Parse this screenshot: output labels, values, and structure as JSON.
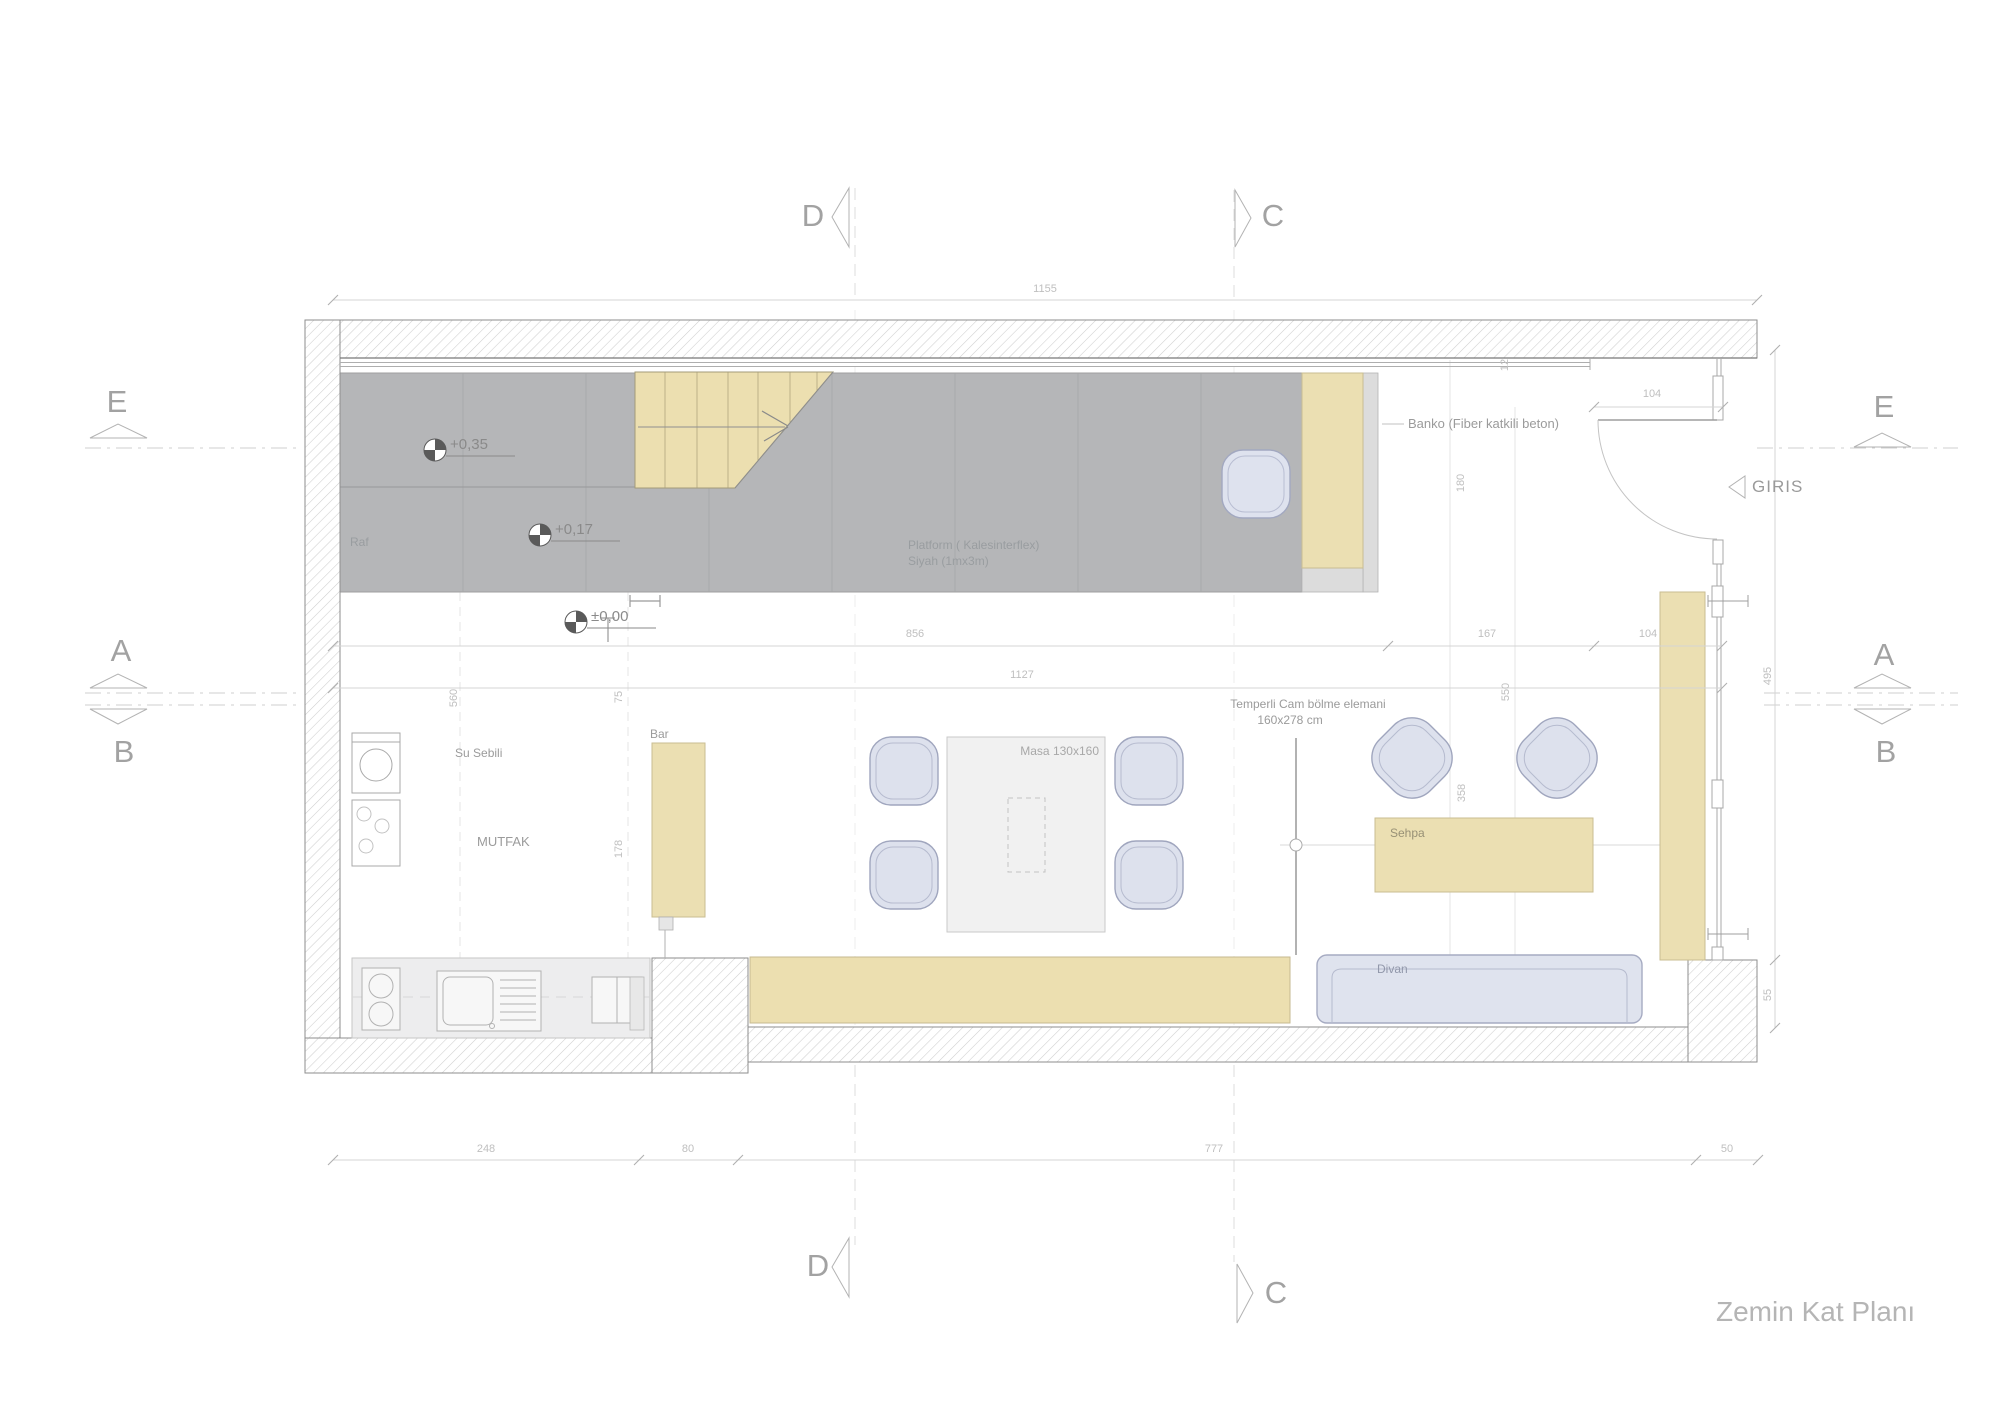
{
  "title": "Zemin Kat Planı",
  "markers": {
    "d": "D",
    "c": "C",
    "e": "E",
    "a": "A",
    "b": "B"
  },
  "entrance": {
    "label": "GIRIS"
  },
  "annotations": {
    "banko": "Banko (Fiber katkili beton)",
    "platform1": "Platform ( Kalesinterflex)",
    "platform2": "Siyah (1mx3m)",
    "raf": "Raf",
    "su_sebili": "Su Sebili",
    "mutfak": "MUTFAK",
    "bar": "Bar",
    "masa": "Masa 130x160",
    "cam1": "Temperli Cam bölme elemani",
    "cam2": "160x278 cm",
    "sehpa": "Sehpa",
    "divan": "Divan"
  },
  "elevations": {
    "level1": "+0,35",
    "level2": "+0,17",
    "level0": "±0,00"
  },
  "dims": {
    "total": "1155",
    "b1": "248",
    "b2": "80",
    "b3": "777",
    "b4": "50",
    "m1": "856",
    "m2": "167",
    "m3": "104",
    "m4": "1127",
    "door": "104",
    "v_right1": "495",
    "v_right2": "55",
    "v1": "560",
    "v2": "75",
    "v3": "178",
    "v4": "180",
    "v5": "550",
    "v6": "358",
    "v7": "12"
  }
}
